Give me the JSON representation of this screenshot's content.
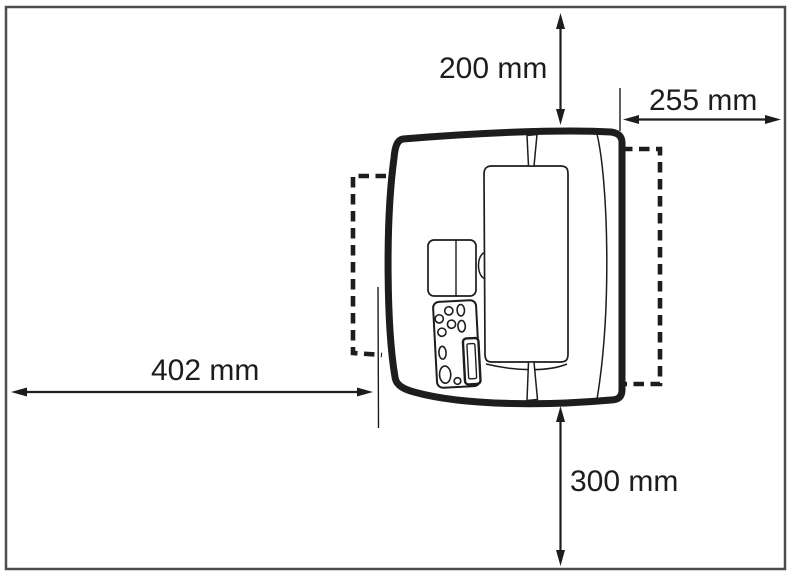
{
  "dimensions": {
    "top": {
      "label": "200 mm"
    },
    "right": {
      "label": "255 mm"
    },
    "left": {
      "label": "402 mm"
    },
    "bottom": {
      "label": "300 mm"
    }
  },
  "colors": {
    "line": "#1d1d1b",
    "frame": "#4d4d4d",
    "background": "#ffffff"
  }
}
